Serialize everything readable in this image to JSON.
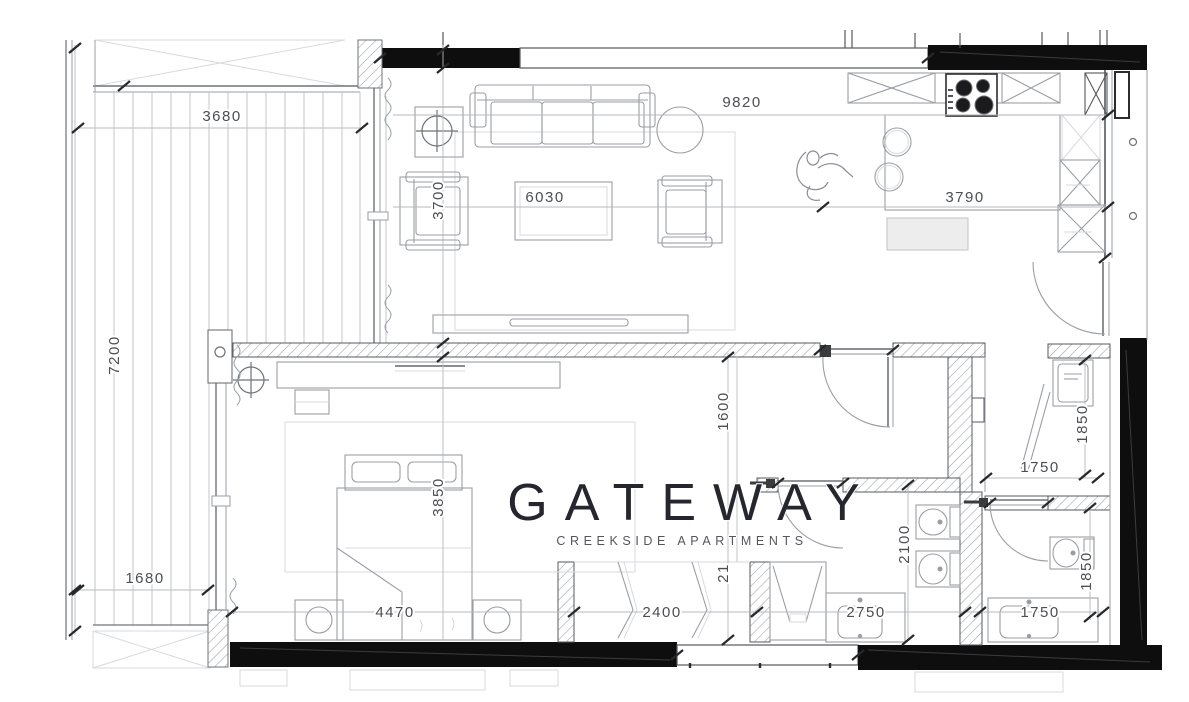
{
  "brand": {
    "name": "GATEWAY",
    "tagline": "CREEKSIDE APARTMENTS"
  },
  "colors": {
    "background": "#ffffff",
    "wall_black": "#0e0e0f",
    "furniture_line": "#9a9ea3",
    "wall_line": "#5f6368",
    "hatch_line": "#a2a6ab",
    "dim_text": "#4c4e52",
    "dim_line": "#b6b9bc"
  },
  "dimensions": {
    "balcony_top_width": "3680",
    "overall_top_width": "9820",
    "living_left_depth": "3700",
    "living_width": "6030",
    "kitchen_width": "3790",
    "balcony_left_height": "7200",
    "balcony_lower_width": "1680",
    "bedroom_depth": "3850",
    "bedroom_width": "4470",
    "hallway_depth": "1600",
    "closet_width": "2400",
    "closet_depth_partial": "21",
    "bath1_depth": "2100",
    "bath1_width": "2750",
    "laundry_depth": "1850",
    "laundry_width": "1750",
    "bath2_depth": "1850",
    "bath2_width": "1750"
  }
}
